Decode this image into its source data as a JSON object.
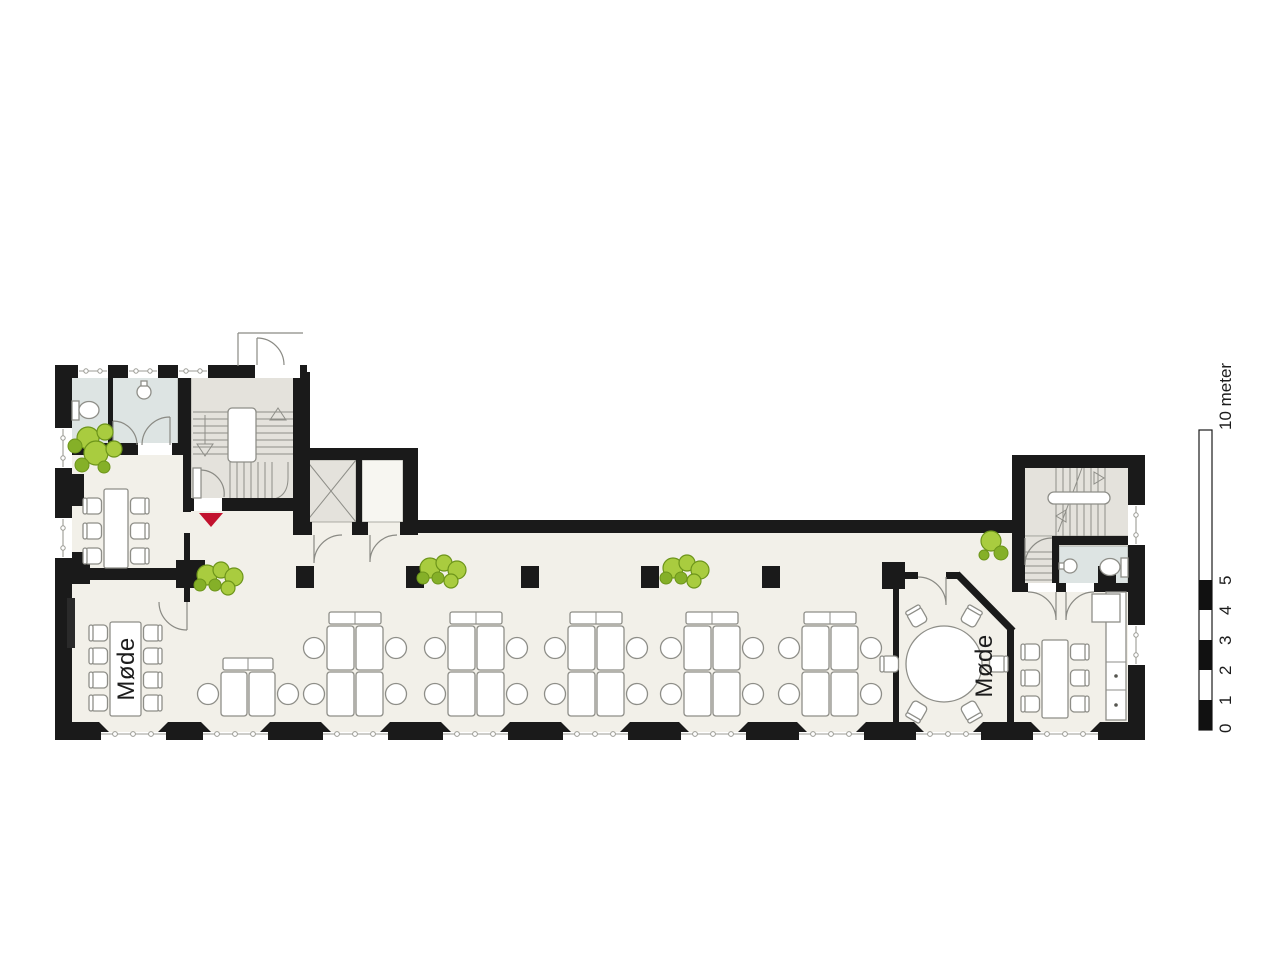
{
  "rooms": {
    "meeting_left": "Møde",
    "meeting_right": "Møde"
  },
  "scale_bar": {
    "ticks": [
      "0",
      "1",
      "2",
      "3",
      "4",
      "5"
    ],
    "unit_label": "10 meter"
  },
  "colors": {
    "wall": "#1a1a1a",
    "floor": "#f2f0e9",
    "toilet": "#dde4e3",
    "stair": "#e4e2dc",
    "line": "#8e8e88",
    "plant": "#a9cc3f",
    "plantdark": "#85b028",
    "plantstroke": "#6d951a",
    "red": "#c2122e"
  }
}
